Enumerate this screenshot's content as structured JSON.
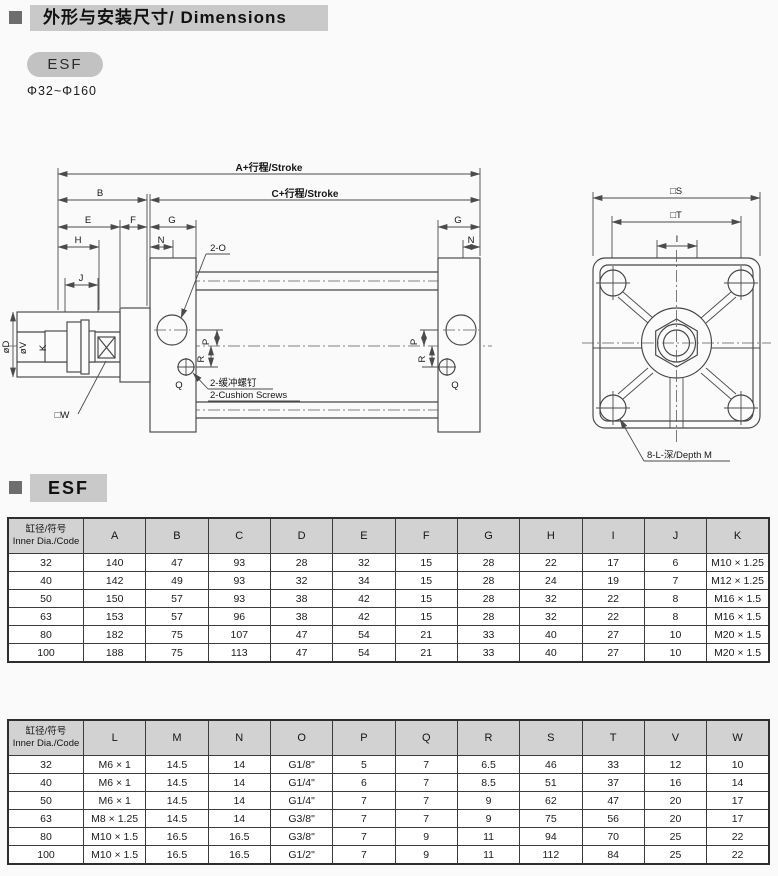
{
  "header": {
    "title": "外形与安装尺寸/ Dimensions",
    "series": "ESF",
    "bore_range": "Φ32~Φ160"
  },
  "section2": {
    "title": "ESF"
  },
  "colors": {
    "title_bar_bg": "#c9c9c9",
    "badge_bg": "#c2c2c2",
    "table_header_bg": "#d2d2d2",
    "drawing_line": "#4b4b4b"
  },
  "drawing": {
    "side_view": {
      "dim_a": "A+行程/Stroke",
      "dim_c": "C+行程/Stroke",
      "dim_b": "B",
      "dim_e": "E",
      "dim_f": "F",
      "dim_g": "G",
      "dim_h": "H",
      "dim_n": "N",
      "dim_j": "J",
      "dim_p": "P",
      "dim_q": "Q",
      "dim_r": "R",
      "dim_od": "øD",
      "dim_ov": "øV",
      "dim_k": "K",
      "dim_w": "□W",
      "port_label": "2-O",
      "cushion_cn": "2-缓冲螺钉",
      "cushion_en": "2-Cushion Screws"
    },
    "end_view": {
      "dim_s": "□S",
      "dim_t": "□T",
      "dim_i": "I",
      "depth_label": "8-L-深/Depth M"
    }
  },
  "table1": {
    "header": [
      "缸径/符号\nInner Dia./Code",
      "A",
      "B",
      "C",
      "D",
      "E",
      "F",
      "G",
      "H",
      "I",
      "J",
      "K"
    ],
    "rows": [
      [
        "32",
        "140",
        "47",
        "93",
        "28",
        "32",
        "15",
        "28",
        "22",
        "17",
        "6",
        "M10 × 1.25"
      ],
      [
        "40",
        "142",
        "49",
        "93",
        "32",
        "34",
        "15",
        "28",
        "24",
        "19",
        "7",
        "M12 × 1.25"
      ],
      [
        "50",
        "150",
        "57",
        "93",
        "38",
        "42",
        "15",
        "28",
        "32",
        "22",
        "8",
        "M16 × 1.5"
      ],
      [
        "63",
        "153",
        "57",
        "96",
        "38",
        "42",
        "15",
        "28",
        "32",
        "22",
        "8",
        "M16 × 1.5"
      ],
      [
        "80",
        "182",
        "75",
        "107",
        "47",
        "54",
        "21",
        "33",
        "40",
        "27",
        "10",
        "M20 × 1.5"
      ],
      [
        "100",
        "188",
        "75",
        "113",
        "47",
        "54",
        "21",
        "33",
        "40",
        "27",
        "10",
        "M20 × 1.5"
      ]
    ]
  },
  "table2": {
    "header": [
      "缸径/符号\nInner Dia./Code",
      "L",
      "M",
      "N",
      "O",
      "P",
      "Q",
      "R",
      "S",
      "T",
      "V",
      "W"
    ],
    "rows": [
      [
        "32",
        "M6 × 1",
        "14.5",
        "14",
        "G1/8\"",
        "5",
        "7",
        "6.5",
        "46",
        "33",
        "12",
        "10"
      ],
      [
        "40",
        "M6 × 1",
        "14.5",
        "14",
        "G1/4\"",
        "6",
        "7",
        "8.5",
        "51",
        "37",
        "16",
        "14"
      ],
      [
        "50",
        "M6 × 1",
        "14.5",
        "14",
        "G1/4\"",
        "7",
        "7",
        "9",
        "62",
        "47",
        "20",
        "17"
      ],
      [
        "63",
        "M8 × 1.25",
        "14.5",
        "14",
        "G3/8\"",
        "7",
        "7",
        "9",
        "75",
        "56",
        "20",
        "17"
      ],
      [
        "80",
        "M10 × 1.5",
        "16.5",
        "16.5",
        "G3/8\"",
        "7",
        "9",
        "11",
        "94",
        "70",
        "25",
        "22"
      ],
      [
        "100",
        "M10 × 1.5",
        "16.5",
        "16.5",
        "G1/2\"",
        "7",
        "9",
        "11",
        "112",
        "84",
        "25",
        "22"
      ]
    ]
  }
}
